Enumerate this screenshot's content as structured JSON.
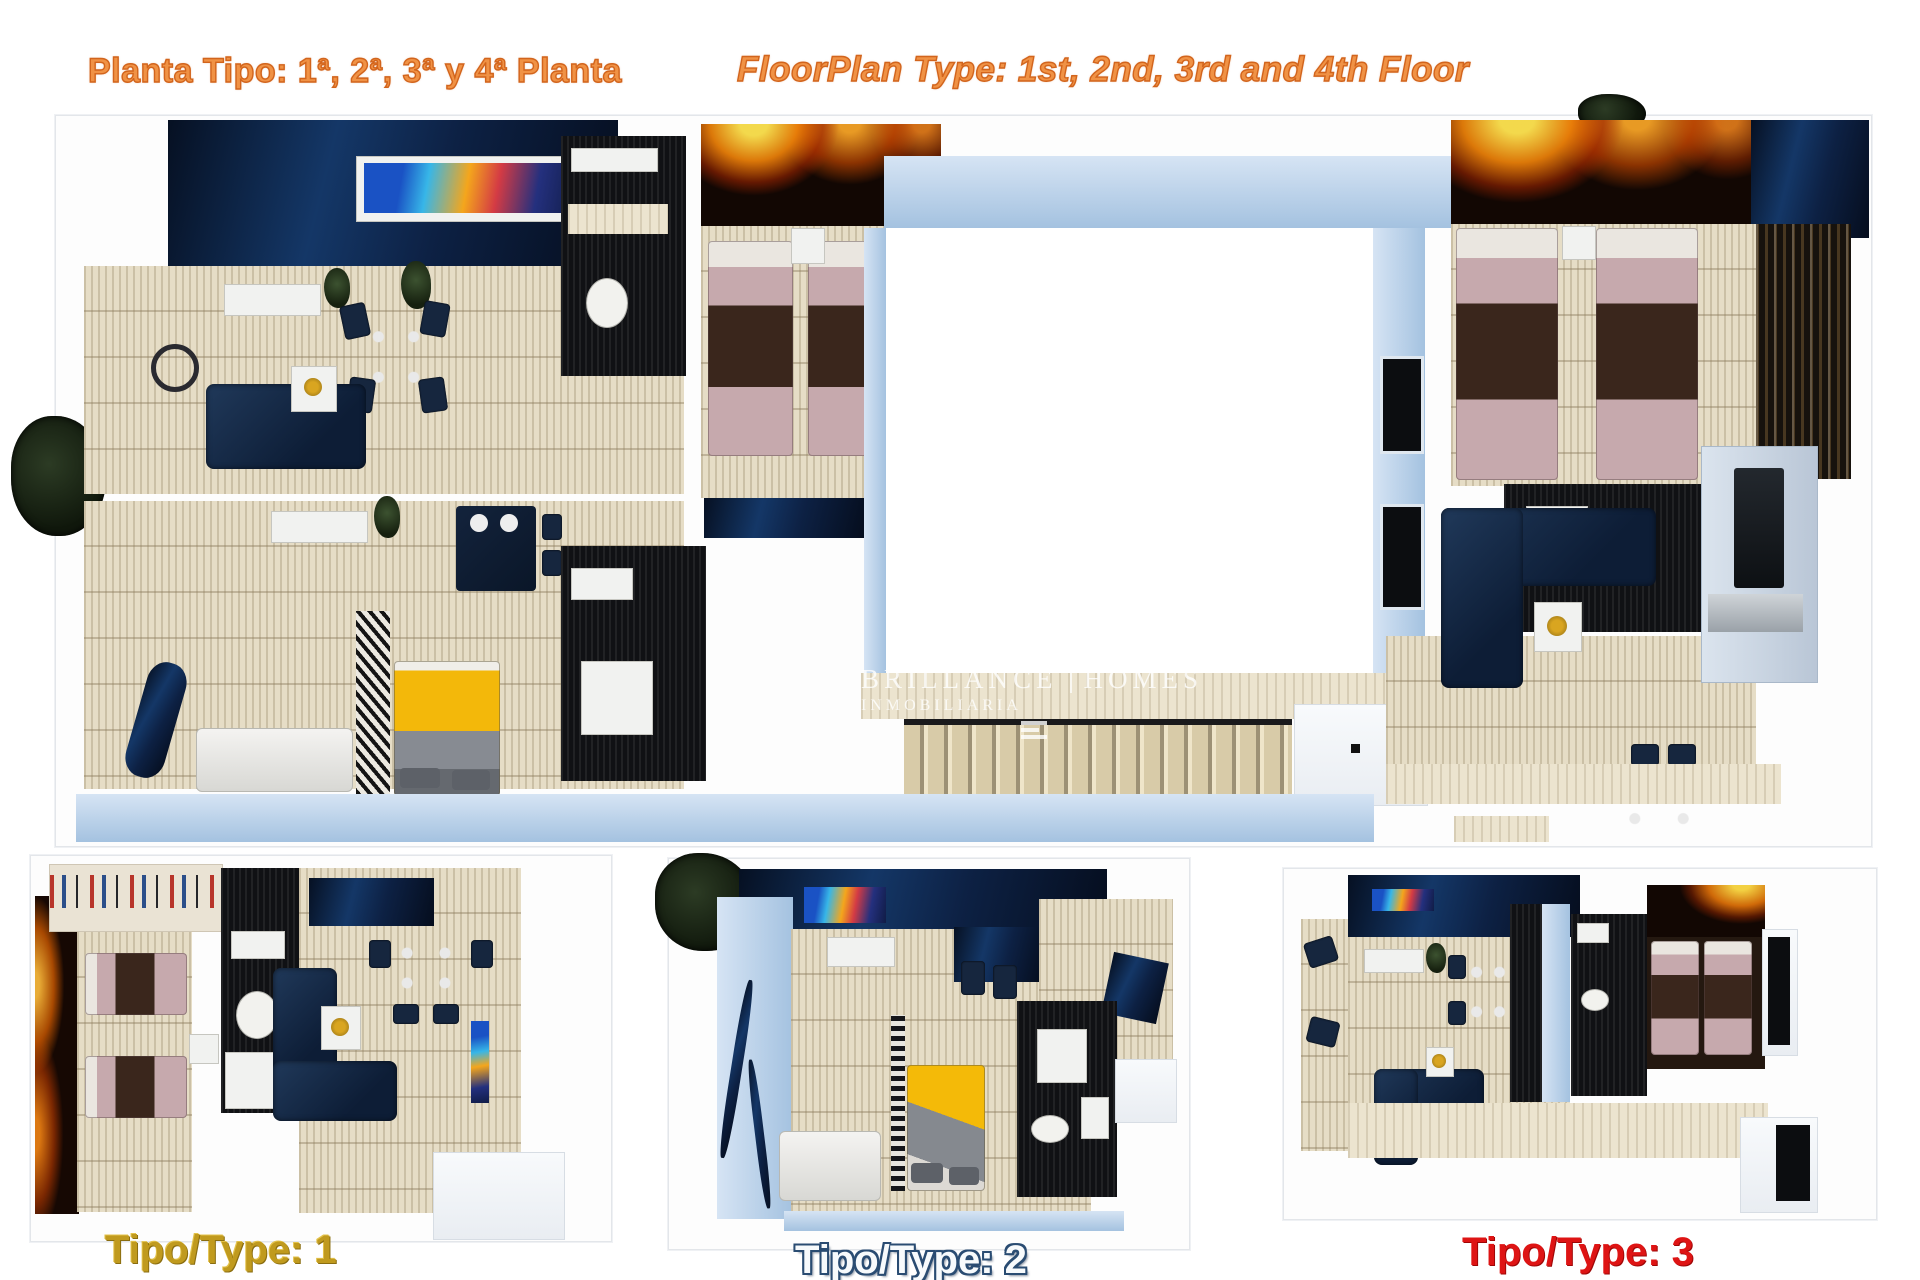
{
  "header": {
    "title_es": "Planta Tipo: 1ª, 2ª, 3ª y 4ª Planta",
    "title_en": "FloorPlan Type: 1st, 2nd, 3rd and 4th Floor",
    "title_color": "#f09245",
    "title_outline_color": "#d2641c"
  },
  "watermark": {
    "brand_word1": "BRILLANCE",
    "brand_word2": "HOMES",
    "subtitle": "INMOBILIARIA"
  },
  "plans": {
    "main": {
      "name": "Planta completa / full floor plan"
    },
    "type1": {
      "label": "Tipo/Type: 1",
      "label_color": "#c09a1e"
    },
    "type2": {
      "label": "Tipo/Type: 2",
      "label_color": "#f7fafc",
      "label_outline": "#2a4c72"
    },
    "type3": {
      "label": "Tipo/Type: 3",
      "label_color": "#de1414"
    }
  },
  "palette": {
    "floor_beige": "#e6ddc6",
    "wall_light_blue": "#b4cce6",
    "wall_navy": "#122a4d",
    "fire_accent": "#ff8c00",
    "bed_pink": "#c6a9ad",
    "blanket_brown": "#3a261c",
    "blanket_yellow": "#f2b60d",
    "sofa_navy": "#14273f"
  }
}
